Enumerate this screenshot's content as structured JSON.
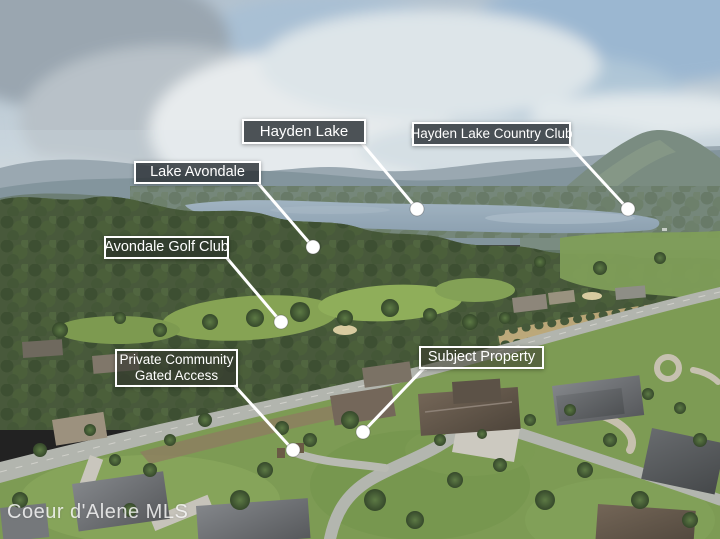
{
  "photo": {
    "kind": "aerial-listing-photo",
    "watermark": "Coeur d'Alene MLS"
  },
  "labels": [
    {
      "id": "hayden-lake",
      "text": "Hayden Lake"
    },
    {
      "id": "hayden-lake-country-club",
      "text": "Hayden Lake Country Club"
    },
    {
      "id": "lake-avondale",
      "text": "Lake Avondale"
    },
    {
      "id": "avondale-golf-club",
      "text": "Avondale Golf Club"
    },
    {
      "id": "private-community",
      "line1": "Private Community",
      "line2": "Gated Access"
    },
    {
      "id": "subject-property",
      "text": "Subject Property"
    }
  ],
  "colors": {
    "label_border": "#ffffff",
    "label_text": "#ffffff",
    "label_background": "rgba(47,53,57,0.84)",
    "leader_line": "#ffffff"
  }
}
